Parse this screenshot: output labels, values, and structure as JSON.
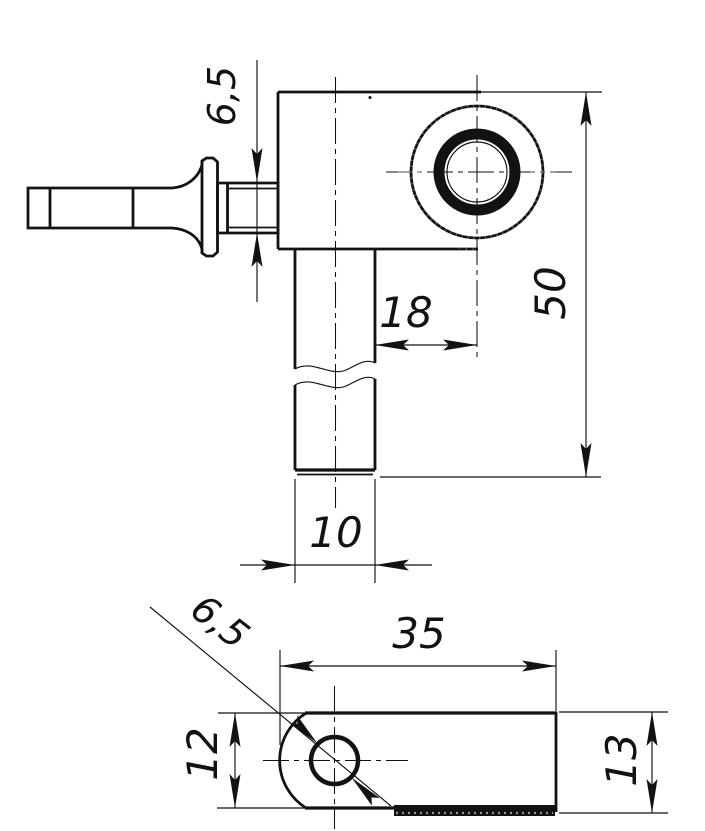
{
  "front_view": {
    "dims": {
      "stub_diameter": "6,5",
      "boss_offset": "18",
      "overall_height": "50",
      "shaft_diameter": "10"
    }
  },
  "bottom_view": {
    "dims": {
      "hole_diameter": "6,5",
      "plate_length": "35",
      "plate_width": "12",
      "plate_height": "13"
    }
  },
  "style": {
    "ink": "#121212",
    "paper": "#ffffff"
  }
}
